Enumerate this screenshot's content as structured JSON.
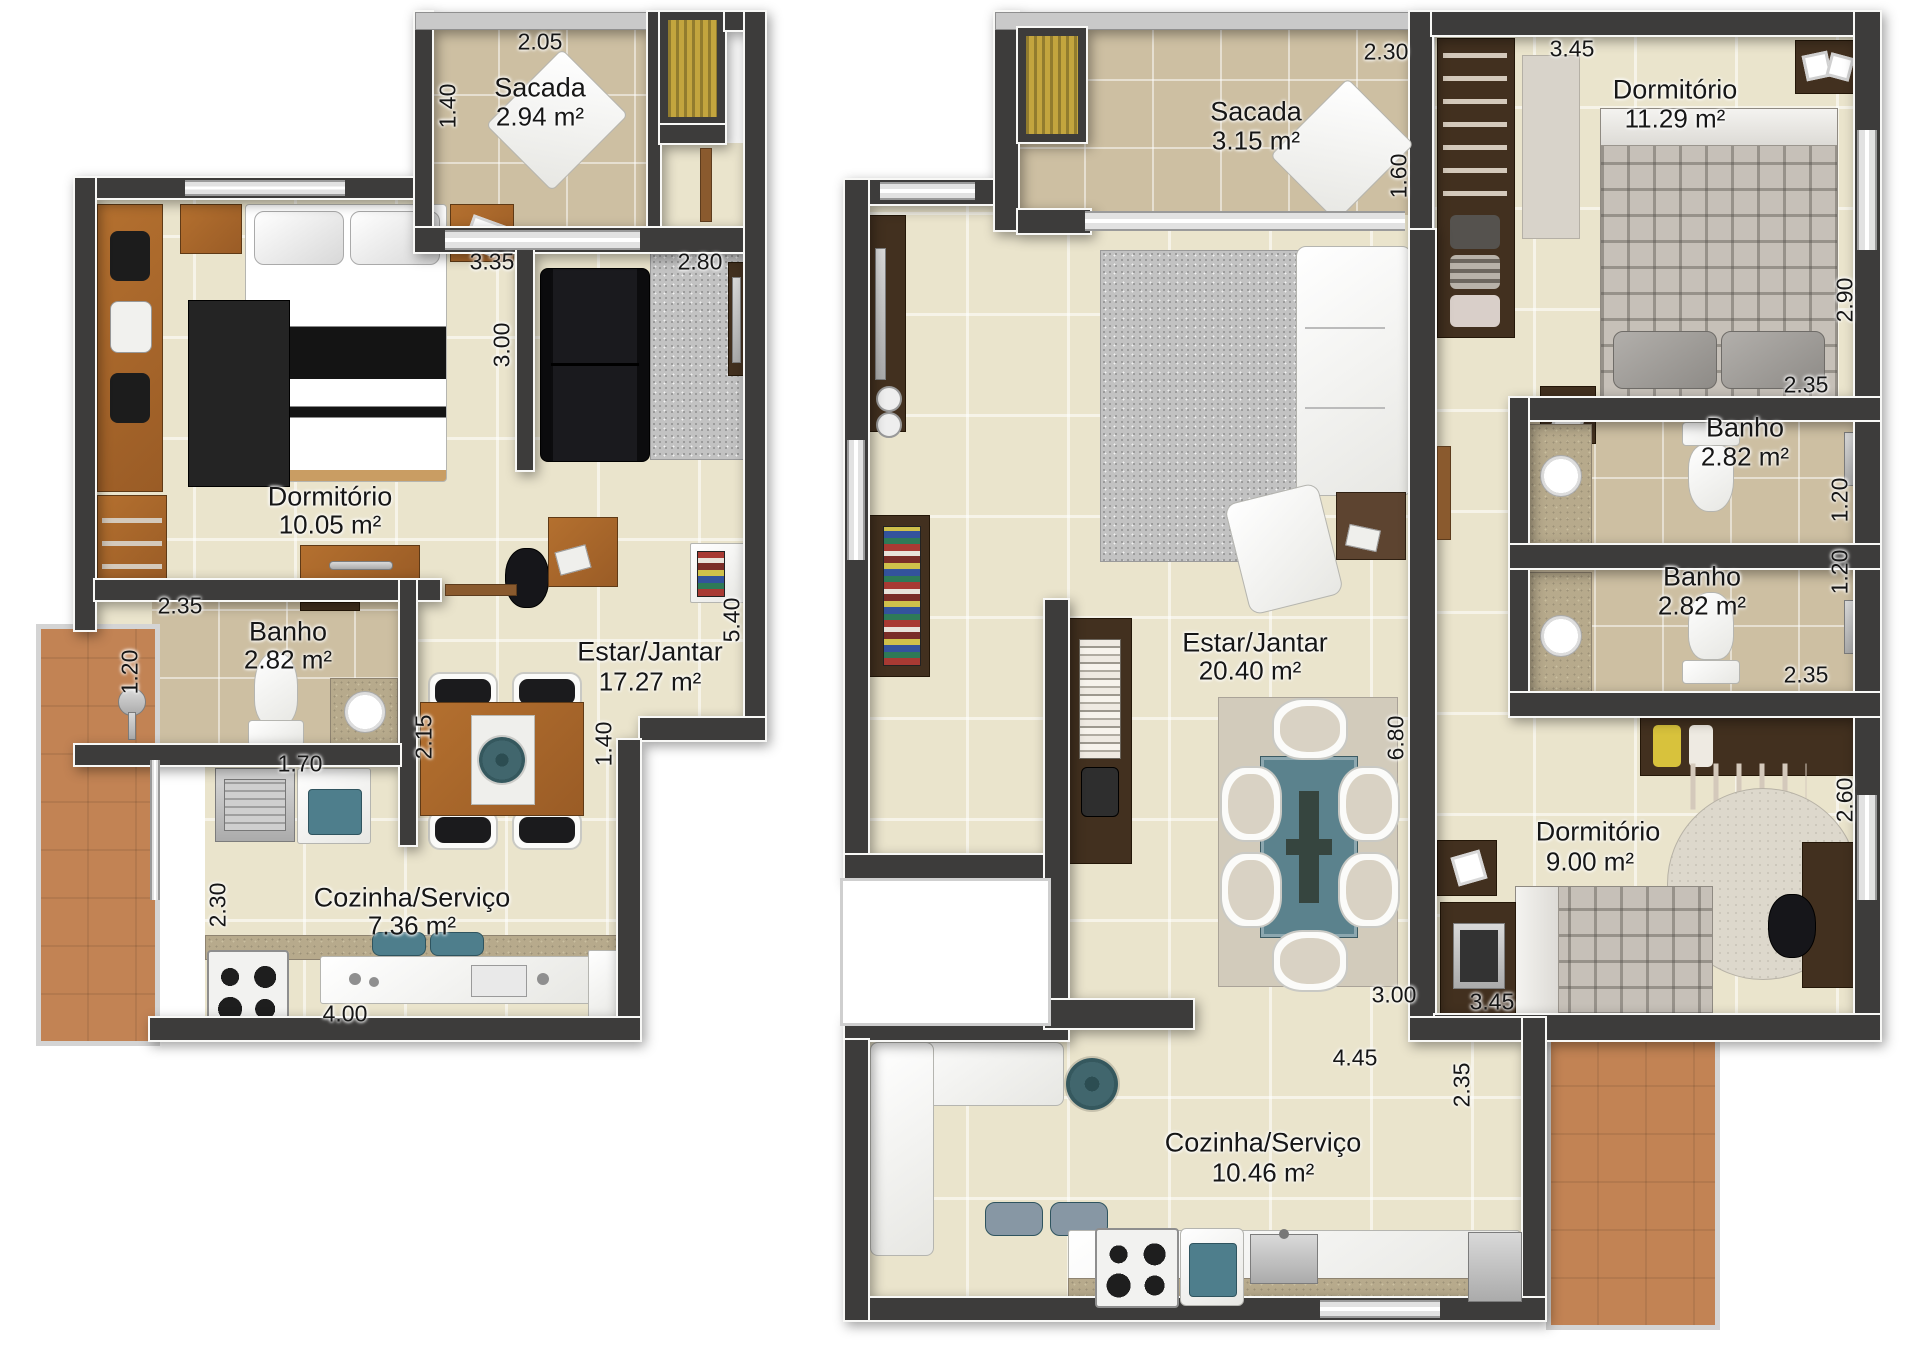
{
  "plans": [
    {
      "id": "plan-left",
      "rooms": [
        {
          "name": "Sacada",
          "area": "2.94 m²"
        },
        {
          "name": "Dormitório",
          "area": "10.05 m²"
        },
        {
          "name": "Banho",
          "area": "2.82 m²"
        },
        {
          "name": "Estar/Jantar",
          "area": "17.27 m²"
        },
        {
          "name": "Cozinha/Serviço",
          "area": "7.36 m²"
        }
      ],
      "dims": [
        "2.05",
        "1.40",
        "3.35",
        "3.00",
        "2.80",
        "2.35",
        "1.20",
        "2.15",
        "1.70",
        "2.30",
        "4.00",
        "1.40",
        "5.40"
      ]
    },
    {
      "id": "plan-right",
      "rooms": [
        {
          "name": "Sacada",
          "area": "3.15 m²"
        },
        {
          "name": "Dormitório",
          "area": "11.29 m²"
        },
        {
          "name": "Banho",
          "area": "2.82 m²"
        },
        {
          "name": "Banho",
          "area": "2.82 m²"
        },
        {
          "name": "Estar/Jantar",
          "area": "20.40 m²"
        },
        {
          "name": "Dormitório",
          "area": "9.00 m²"
        },
        {
          "name": "Cozinha/Serviço",
          "area": "10.46 m²"
        }
      ],
      "dims": [
        "2.30",
        "1.60",
        "3.45",
        "2.90",
        "2.35",
        "1.20",
        "1.20",
        "2.35",
        "6.80",
        "2.60",
        "3.00",
        "3.45",
        "4.45",
        "2.35"
      ]
    }
  ],
  "colors": {
    "wall": "#3d3c3b",
    "floor": "#eae4cc",
    "bath_tile": "#cdbfa2",
    "terracotta": "#c28354",
    "wood": "#a9672f",
    "dark_wood": "#42301f",
    "teal": "#4e7e8c",
    "yellow_vent": "#c3a53e",
    "text": "#161616"
  }
}
